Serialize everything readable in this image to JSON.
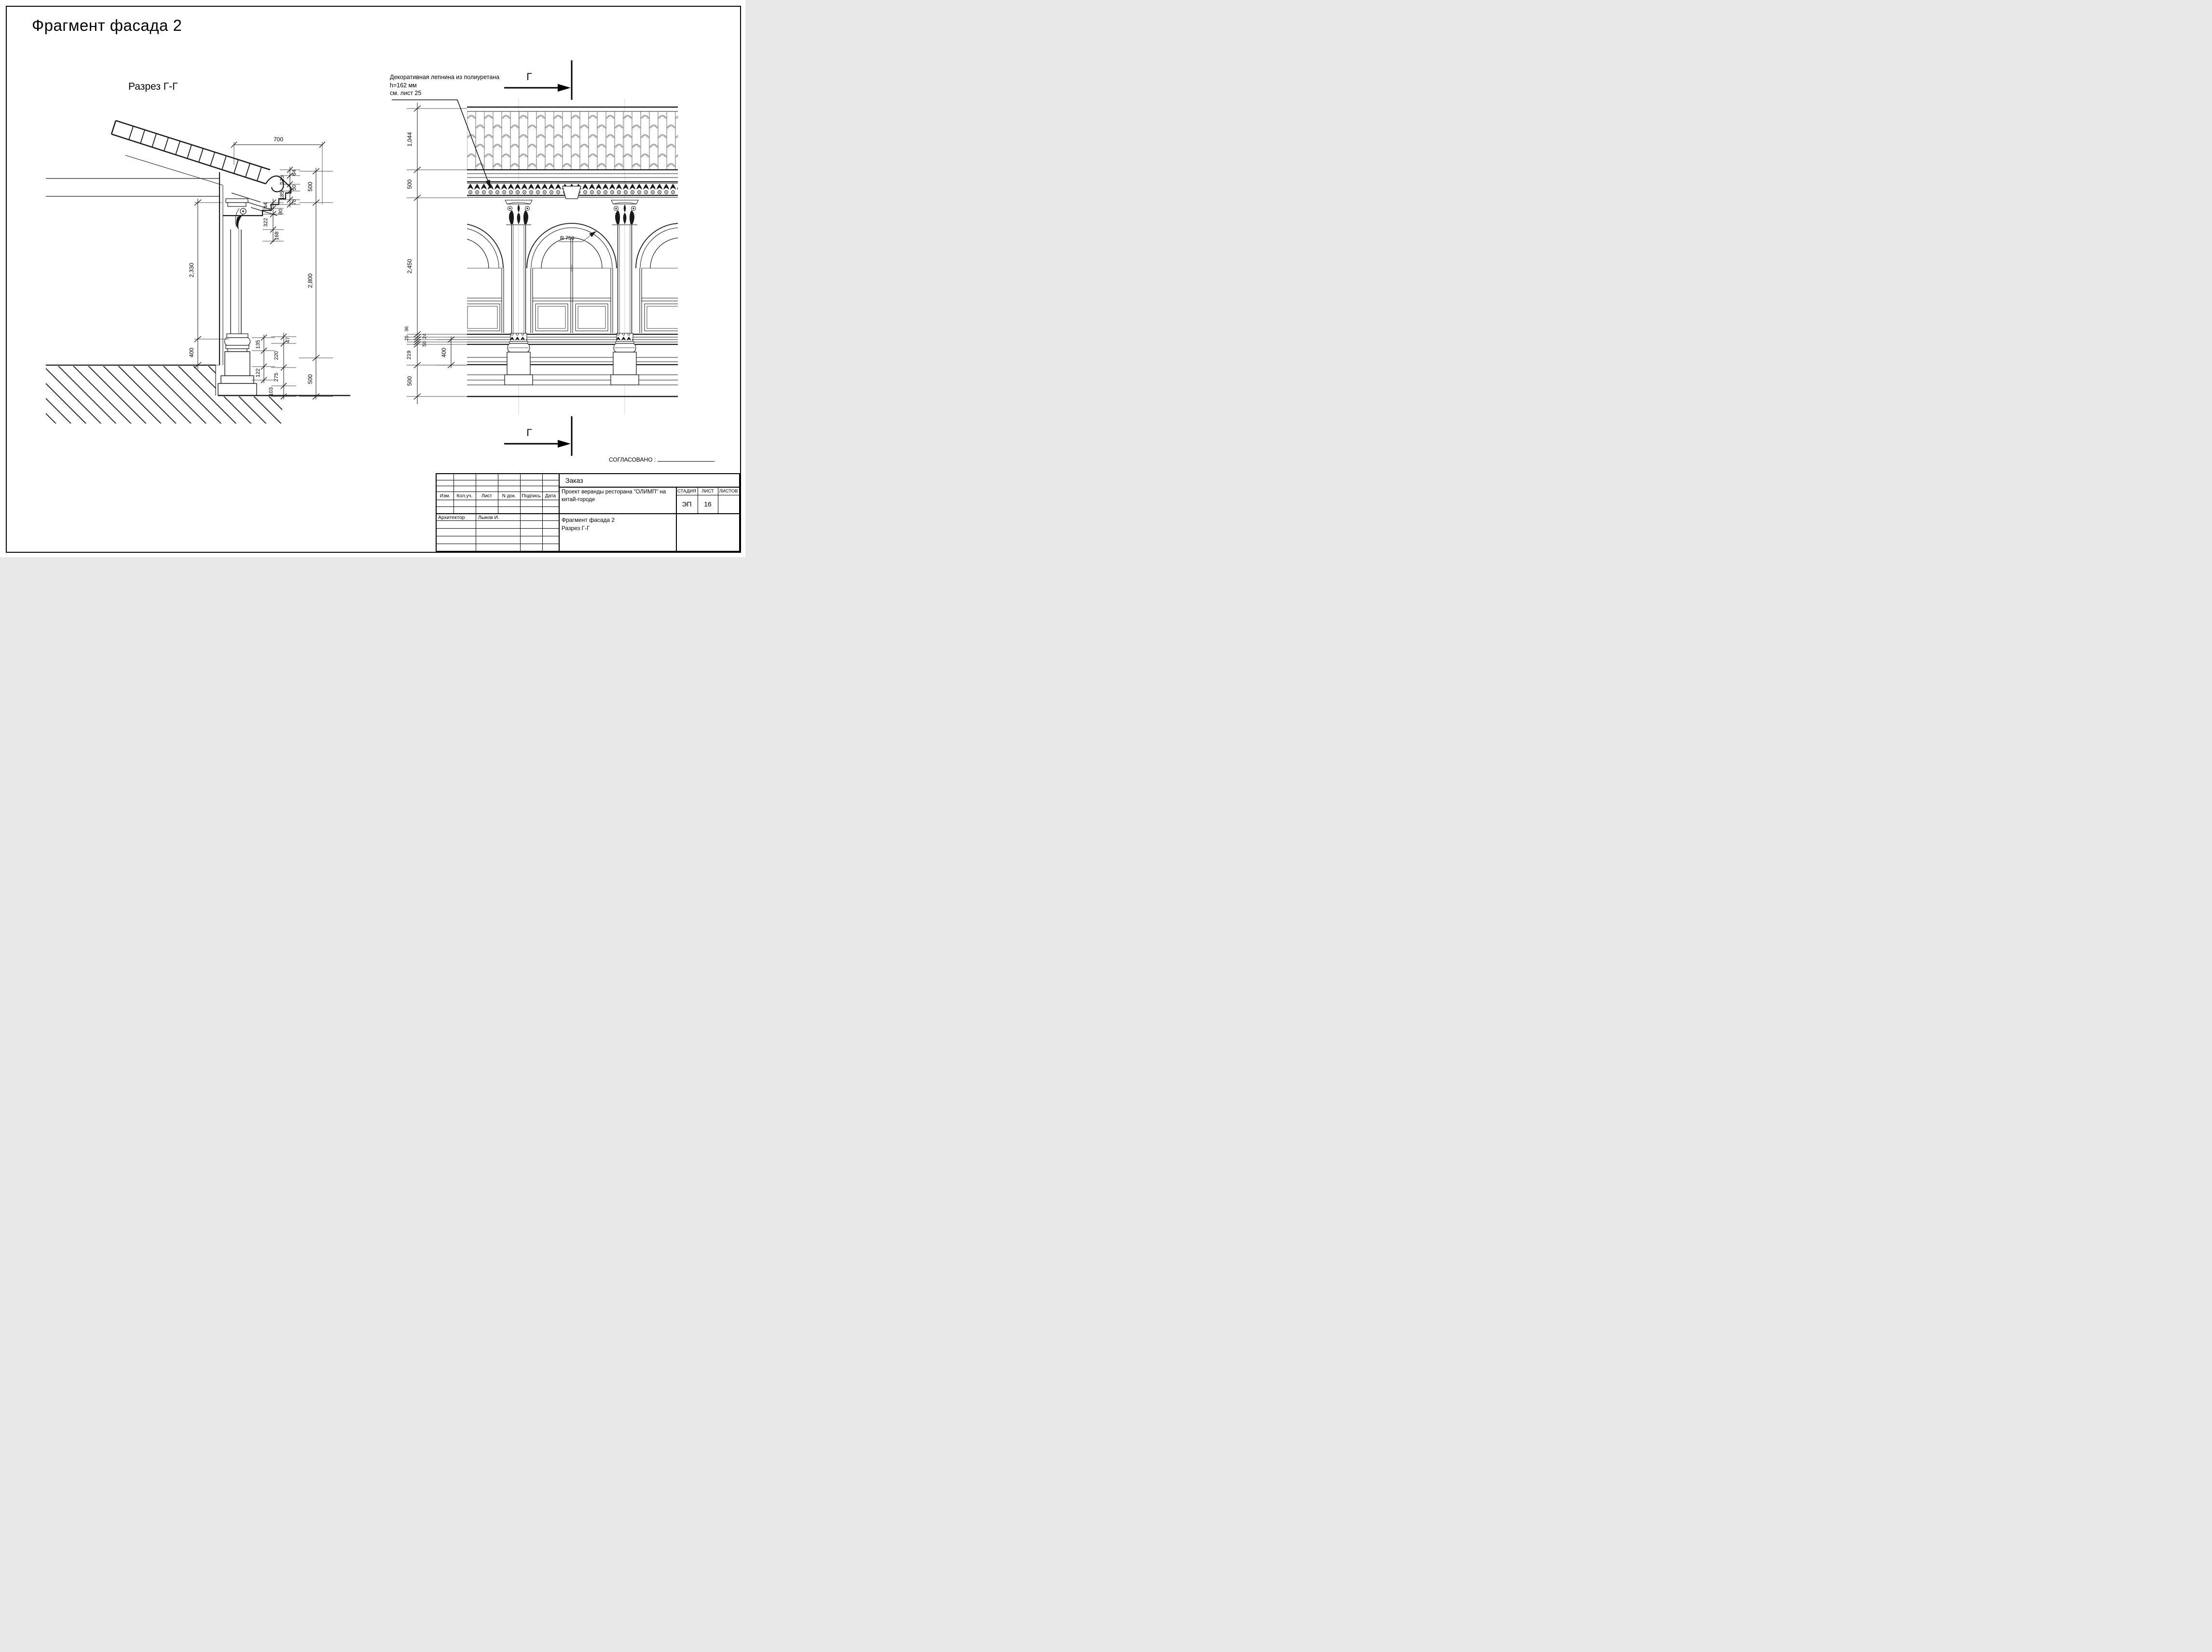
{
  "sheet": {
    "title": "Фрагмент фасада 2"
  },
  "section": {
    "label": "Разрез Г-Г",
    "dim_width_top": "700",
    "dims_right": [
      "500",
      "2,800",
      "500"
    ],
    "dims_left": [
      "2,330",
      "400"
    ],
    "dims_cornice": [
      "64",
      "50",
      "125",
      "185",
      "78"
    ],
    "dims_capital": [
      "44",
      "80",
      "322",
      "168"
    ],
    "dims_base_inner": [
      "135",
      "122"
    ],
    "dims_base_outer": [
      "47",
      "220",
      "275",
      "103"
    ]
  },
  "elevation": {
    "section_letter": "Г",
    "radius_label": "R 750",
    "annotation_lines": [
      "Декоративная лепнина из полиуретана",
      "h=162 мм",
      "см. лист 25"
    ],
    "dims_main": [
      "1,044",
      "500",
      "2,450",
      "219",
      "500"
    ],
    "dims_plinth": [
      "36",
      "25",
      "24",
      "50"
    ],
    "dim_pedestal": "400"
  },
  "approval_label": "СОГЛАСОВАНО :",
  "titleblock": {
    "order_label": "Заказ",
    "columns": [
      "Изм.",
      "Кол.уч.",
      "Лист",
      "N док.",
      "Подпись",
      "Дата"
    ],
    "role_label": "Архитектор",
    "author": "Лыков И.",
    "project_line1": "Проект веранды ресторана \"ОЛИМП\" на",
    "project_line2": "китай-городе",
    "stage_label": "СТАДИЯ",
    "sheet_label": "ЛИСТ",
    "sheets_label": "ЛИСТОВ",
    "stage_value": "ЭП",
    "sheet_value": "16",
    "title_line1": "Фрагмент фасада 2",
    "title_line2": "Разрез Г-Г"
  }
}
